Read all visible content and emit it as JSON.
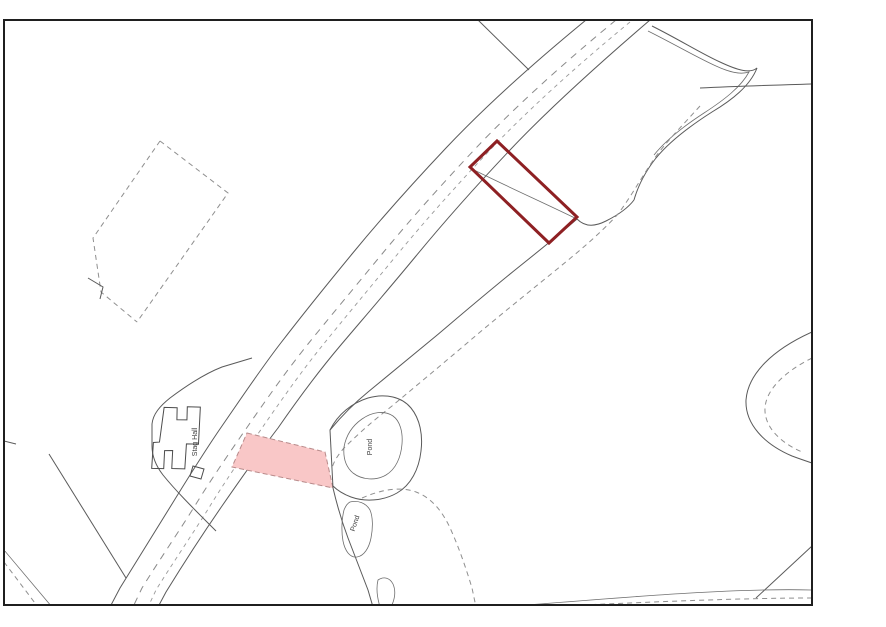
{
  "map": {
    "title": "site-location-plan",
    "labels": {
      "building": "Stag Hall",
      "pond_upper": "Pond",
      "pond_lower": "Pond"
    },
    "colors": {
      "plot_outline": "#8e2023",
      "highlight_fill": "#f9c7c7",
      "highlight_stroke": "#b98b8b",
      "frame": "#1f1f1f",
      "background": "#ffffff"
    }
  }
}
